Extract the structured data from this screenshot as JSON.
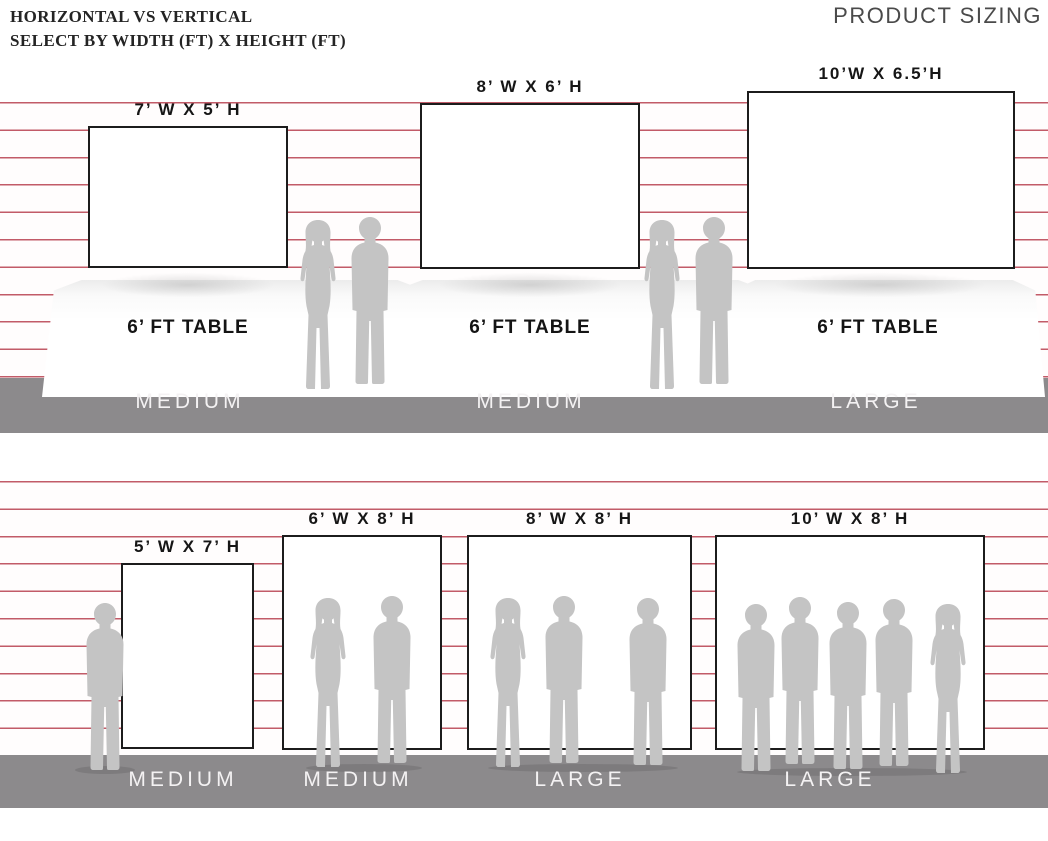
{
  "header": {
    "title_line1": "HORIZONTAL VS VERTICAL",
    "title_line2": "SELECT BY WIDTH (FT) X HEIGHT (FT)",
    "brand": "PRODUCT SIZING"
  },
  "colors": {
    "stripe_line": "#c25b68",
    "floor": "#8c8a8c",
    "silhouette": "#c4c4c4",
    "backdrop_border": "#1c1c1c"
  },
  "top_row": {
    "orientation": "horizontal",
    "items": [
      {
        "size_label": "7’ W X 5’ H",
        "table_label": "6’ FT TABLE",
        "tier": "MEDIUM",
        "people_beside": 0
      },
      {
        "size_label": "8’ W X 6’ H",
        "table_label": "6’ FT TABLE",
        "tier": "MEDIUM",
        "people_beside": 2
      },
      {
        "size_label": "10’W X 6.5’H",
        "table_label": "6’ FT TABLE",
        "tier": "LARGE",
        "people_beside": 2
      }
    ]
  },
  "bottom_row": {
    "orientation": "vertical",
    "items": [
      {
        "size_label": "5’ W X 7’ H",
        "tier": "MEDIUM",
        "people": 1
      },
      {
        "size_label": "6’ W X 8’ H",
        "tier": "MEDIUM",
        "people": 2
      },
      {
        "size_label": "8’ W X 8’ H",
        "tier": "LARGE",
        "people": 3
      },
      {
        "size_label": "10’ W X 8’ H",
        "tier": "LARGE",
        "people": 5
      }
    ]
  }
}
